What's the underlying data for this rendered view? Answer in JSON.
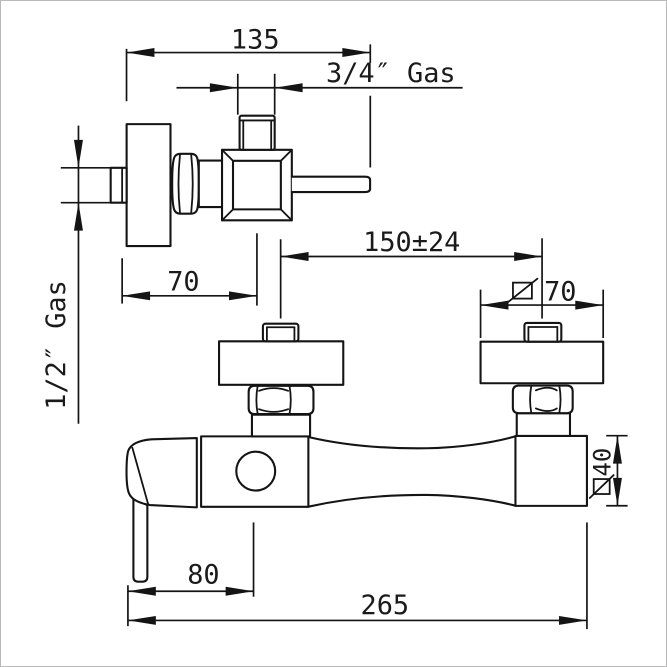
{
  "drawing": {
    "side_view": {
      "depth_dim": "135",
      "top_outlet_thread": "3/4″ Gas",
      "wall_inlet_thread": "1/2″ Gas",
      "center_offset_dim": "70"
    },
    "front_view": {
      "inlet_spacing_dim": "150±24",
      "flange_dim": {
        "symbol": "ø",
        "value": "70"
      },
      "body_dim": {
        "symbol": "ø",
        "value": "40"
      },
      "handle_offset_dim": "80",
      "overall_width_dim": "265"
    }
  }
}
